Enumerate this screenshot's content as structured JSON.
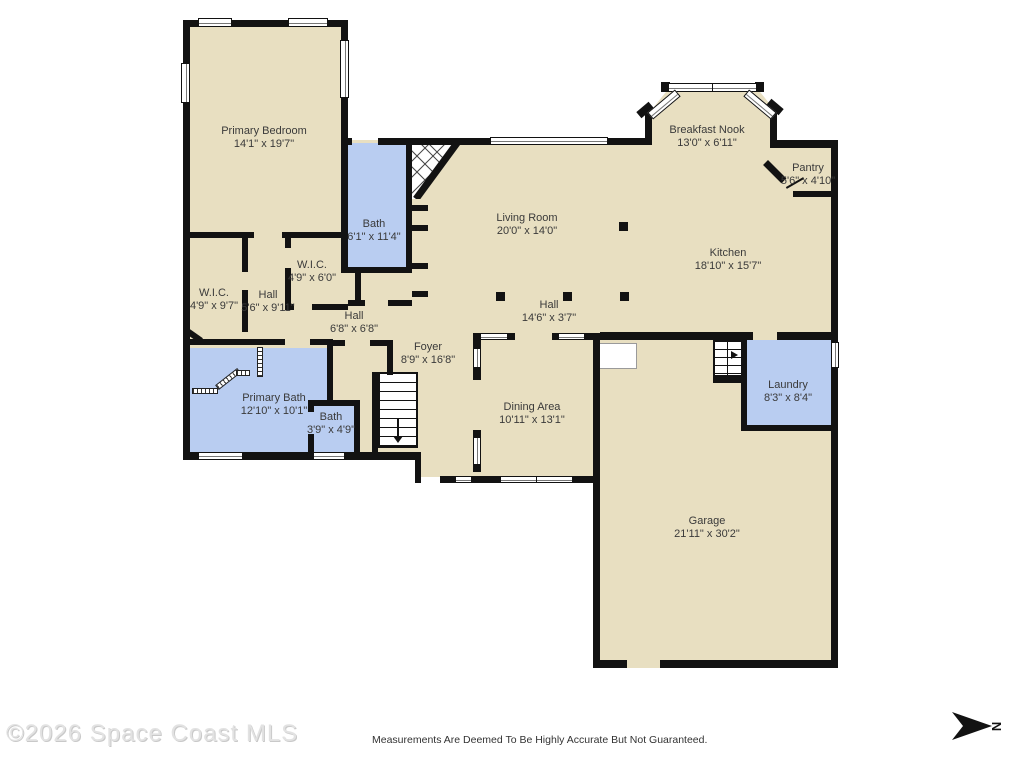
{
  "rooms": [
    {
      "name": "Primary Bedroom",
      "dims": "14'1\" x 19'7\""
    },
    {
      "name": "Bath",
      "dims": "6'1\" x 11'4\""
    },
    {
      "name": "W.I.C.",
      "dims": "4'9\" x 6'0\""
    },
    {
      "name": "W.I.C.",
      "dims": "4'9\" x 9'7\""
    },
    {
      "name": "Hall",
      "dims": "5'6\" x 9'11\""
    },
    {
      "name": "Hall",
      "dims": "6'8\" x 6'8\""
    },
    {
      "name": "Foyer",
      "dims": "8'9\" x 16'8\""
    },
    {
      "name": "Primary Bath",
      "dims": "12'10\" x 10'1\""
    },
    {
      "name": "Bath",
      "dims": "3'9\" x 4'9\""
    },
    {
      "name": "Living Room",
      "dims": "20'0\" x 14'0\""
    },
    {
      "name": "Hall",
      "dims": "14'6\" x 3'7\""
    },
    {
      "name": "Dining Area",
      "dims": "10'11\" x 13'1\""
    },
    {
      "name": "Breakfast Nook",
      "dims": "13'0\" x 6'11\""
    },
    {
      "name": "Pantry",
      "dims": "5'6\" x 4'10\""
    },
    {
      "name": "Kitchen",
      "dims": "18'10\" x 15'7\""
    },
    {
      "name": "Laundry",
      "dims": "8'3\" x 8'4\""
    },
    {
      "name": "Garage",
      "dims": "21'11\" x 30'2\""
    }
  ],
  "footer": {
    "copyright": "©2026 Space Coast MLS",
    "disclaimer": "Measurements Are Deemed To Be Highly Accurate But Not Guaranteed.",
    "north_label": "N"
  },
  "colors": {
    "floor": "#e8dfc1",
    "wet_room": "#b9cdf1",
    "wall": "#121212",
    "background": "#ffffff"
  }
}
